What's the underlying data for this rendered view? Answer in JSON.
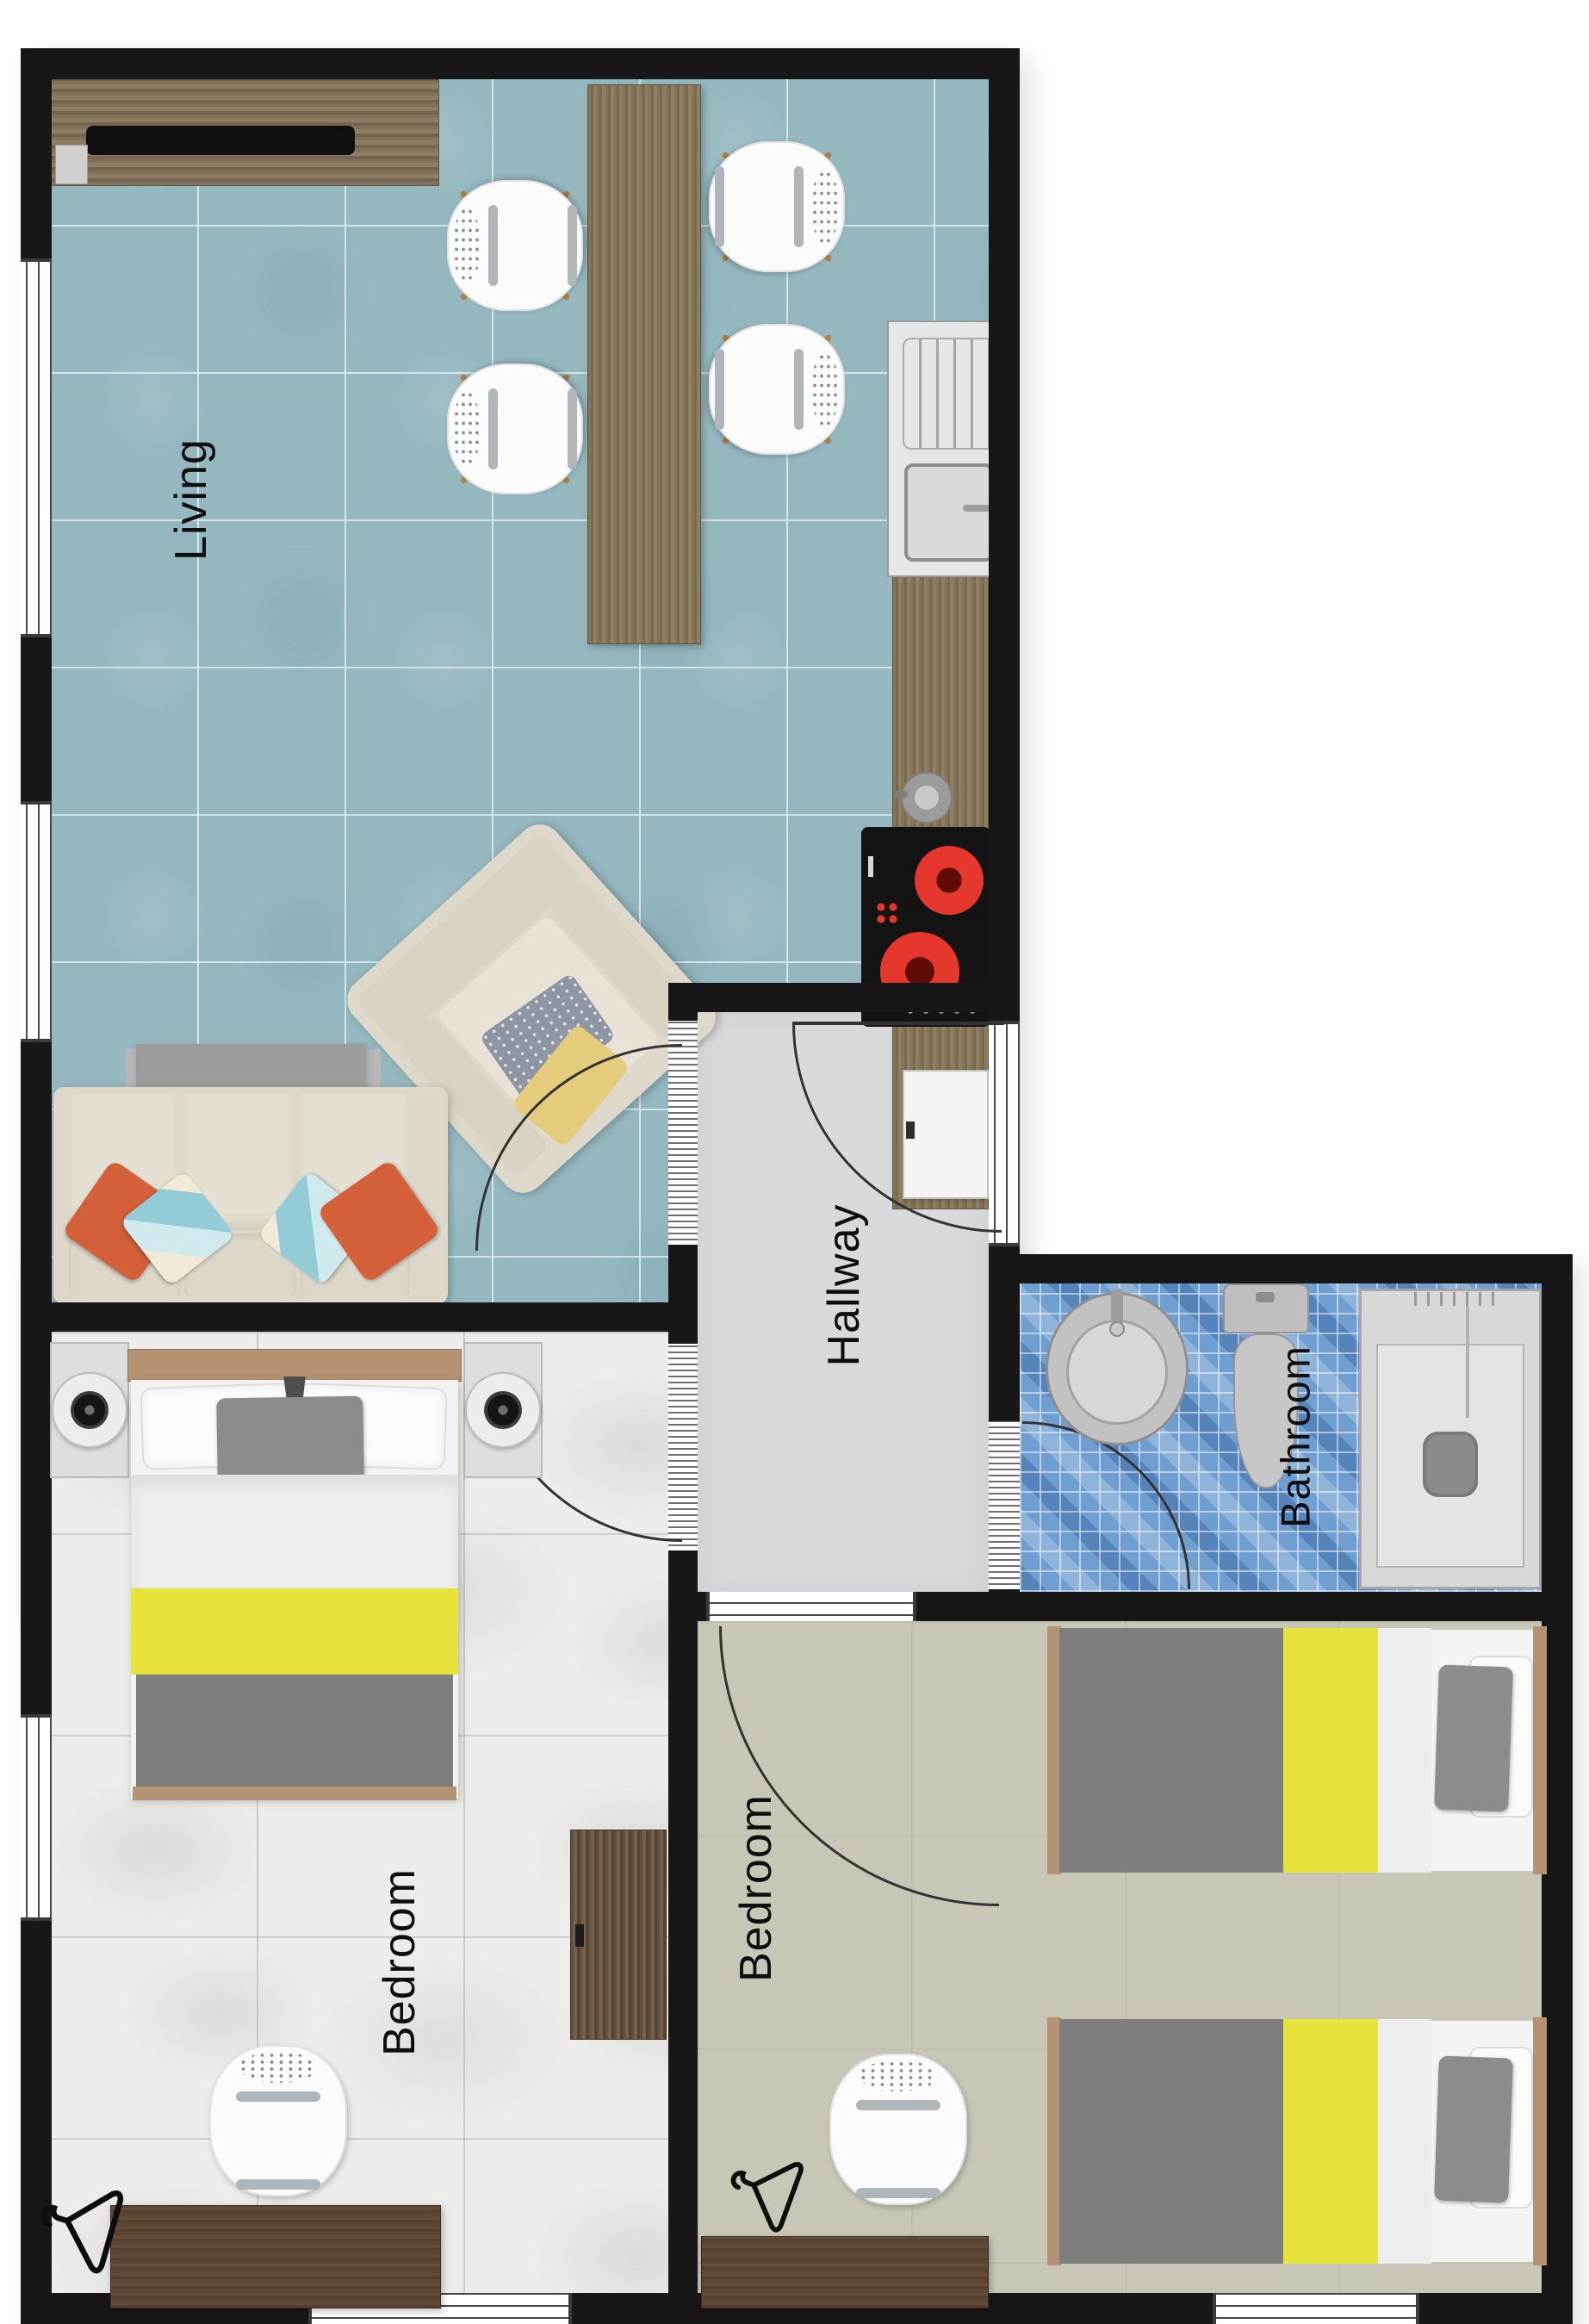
{
  "labels": {
    "living": "Living",
    "hallway": "Hallway",
    "bathroom": "Bathroom",
    "bedroom_left": "Bedroom",
    "bedroom_right": "Bedroom"
  },
  "colors": {
    "wall": "#171717",
    "living-floor": "#95b8bf",
    "hall-floor": "#d9d9dc",
    "bath-floor": "#6f9fd0",
    "bedl-floor": "#ececea",
    "bedr-floor": "#c8c7b7",
    "headboard": "#b59273",
    "yellow": "#e8e33b",
    "blanket": "#7e7e7e",
    "burner": "#e5372b",
    "orange": "#d4603a",
    "teal": "#92ccd6",
    "cream": "#ddd8ca",
    "label": "#0e0e0e"
  },
  "furniture": {
    "living": [
      "tv-console",
      "tv",
      "dining-table",
      "dining-chair",
      "dining-chair",
      "dining-chair",
      "dining-chair",
      "armchair",
      "coffee-table",
      "sofa",
      "pillow-orange",
      "pillow-teal"
    ],
    "kitchen": [
      "counter",
      "sink-unit",
      "kettle",
      "cooktop",
      "appliance"
    ],
    "bathroom": [
      "washbasin",
      "toilet",
      "shower"
    ],
    "bedroom_left": [
      "double-bed",
      "nightstand",
      "nightstand",
      "lamp",
      "lamp",
      "dresser",
      "desk",
      "desk-chair",
      "coat-hanger"
    ],
    "bedroom_right": [
      "twin-bed",
      "twin-bed",
      "desk",
      "desk-chair",
      "coat-hanger"
    ]
  }
}
